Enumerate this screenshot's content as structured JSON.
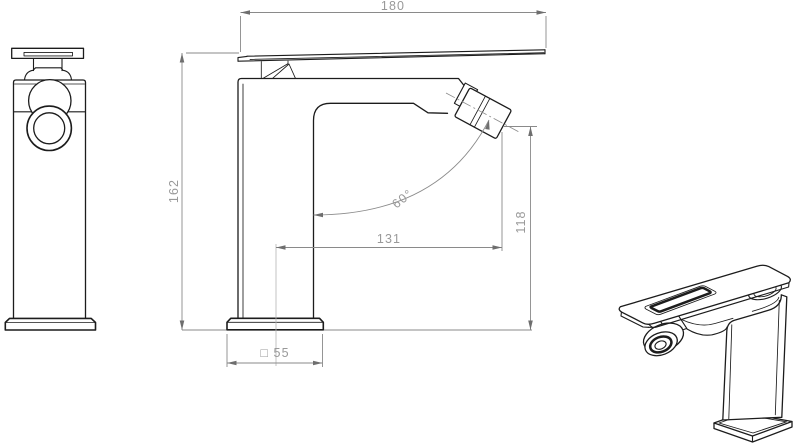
{
  "drawing": {
    "background": "#ffffff",
    "object_line_color": "#1c1c1c",
    "dimension_line_color": "#8a8a8a",
    "dimension_text_color": "#999999",
    "dimensions": {
      "overall_width": "180",
      "overall_height": "162",
      "spout_reach": "131",
      "outlet_height": "118",
      "outlet_angle": "60°",
      "base_square": "□ 55"
    }
  }
}
